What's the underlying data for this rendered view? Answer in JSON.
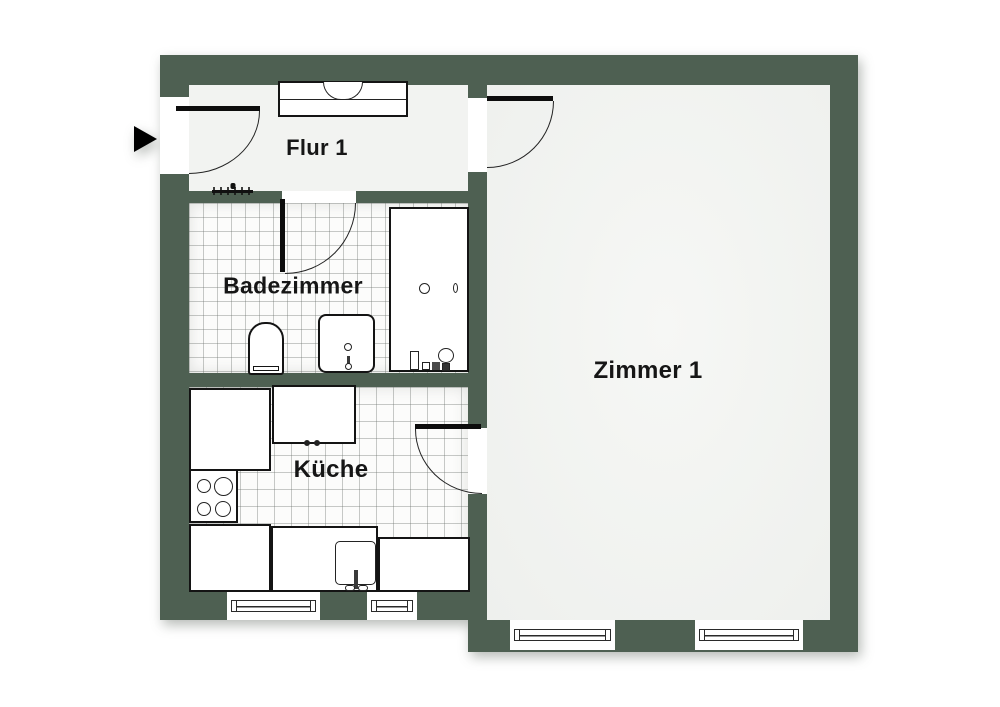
{
  "title": "Apartment floor plan",
  "rooms": [
    {
      "id": "flur-1",
      "label": "Flur 1"
    },
    {
      "id": "badezimmer",
      "label": "Badezimmer"
    },
    {
      "id": "kueche",
      "label": "Küche"
    },
    {
      "id": "zimmer-1",
      "label": "Zimmer 1"
    }
  ],
  "colors": {
    "wall": "#4e6052",
    "floor": "#f2f3f1",
    "tile_line": "#6e746e",
    "line": "#141414",
    "background": "#ffffff"
  },
  "fixtures": [
    "entrance-arrow-icon",
    "wardrobe-icon",
    "radiator-icon",
    "door-swing-icon",
    "window-icon",
    "toilet-icon",
    "washbasin-icon",
    "bathtub-icon",
    "stove-icon",
    "kitchen-sink-icon",
    "kitchen-counter"
  ],
  "counts": {
    "windows": 4,
    "doors": 4
  }
}
